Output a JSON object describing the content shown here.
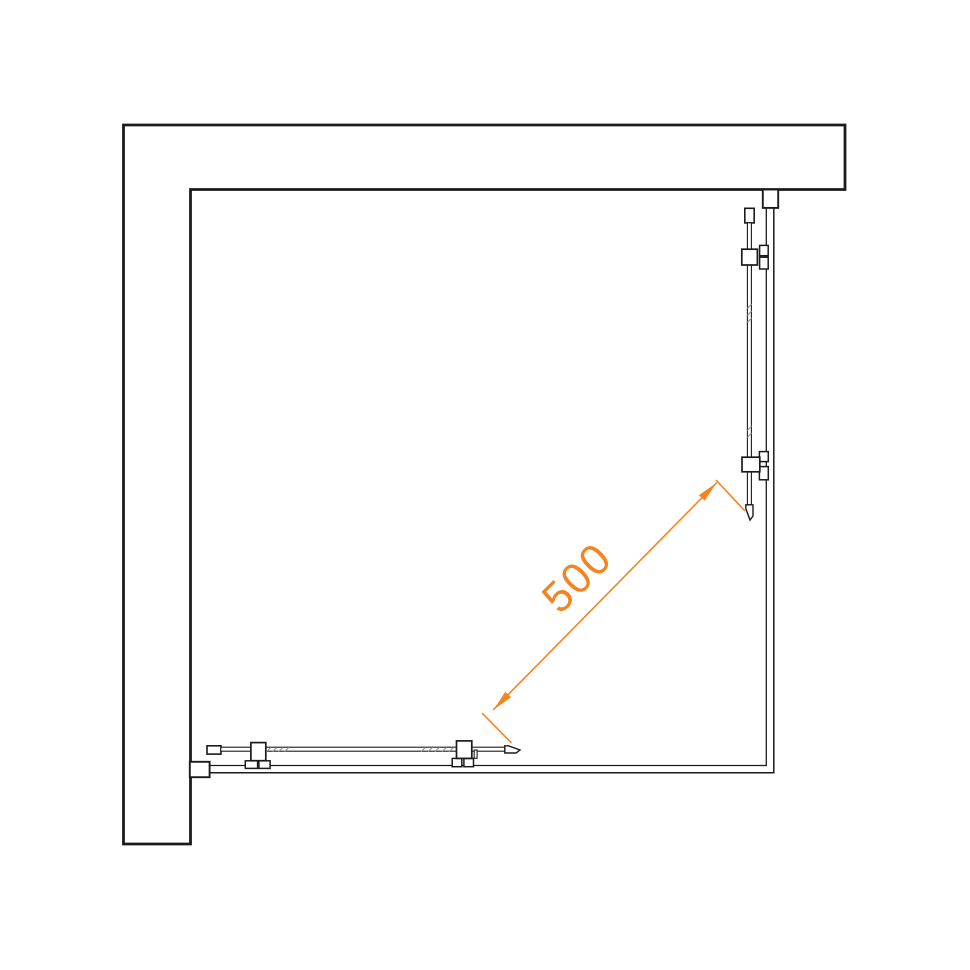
{
  "diagram": {
    "dimension": {
      "label": "500",
      "color": "#F5831F"
    },
    "colors": {
      "line": "#1b1b1b",
      "hatch": "#8f8f8f",
      "background": "#ffffff"
    }
  }
}
